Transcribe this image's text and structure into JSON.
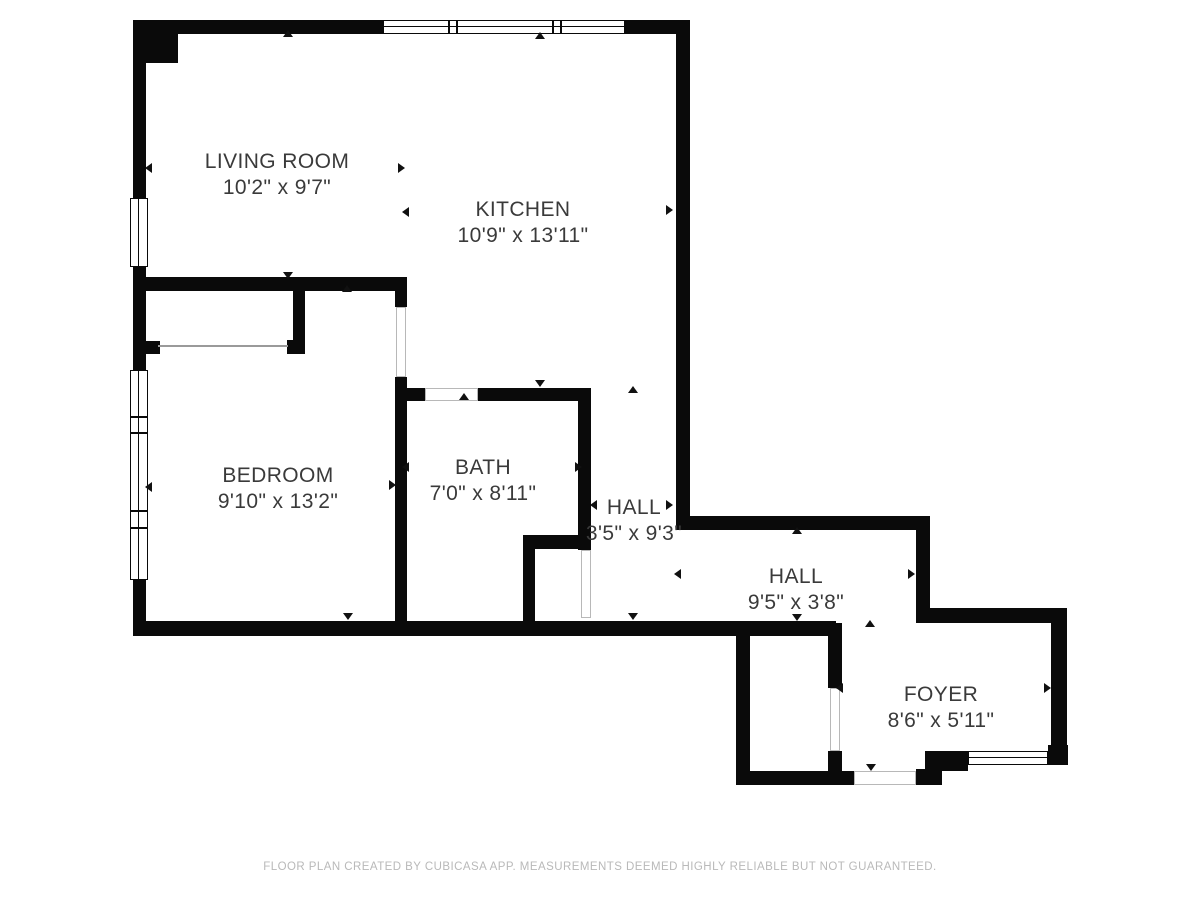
{
  "plan": {
    "rooms": [
      {
        "name": "LIVING ROOM",
        "dims": "10'2\" x 9'7\""
      },
      {
        "name": "KITCHEN",
        "dims": "10'9\" x 13'11\""
      },
      {
        "name": "BEDROOM",
        "dims": "9'10\" x 13'2\""
      },
      {
        "name": "BATH",
        "dims": "7'0\" x 8'11\""
      },
      {
        "name": "HALL",
        "dims": "3'5\" x 9'3\""
      },
      {
        "name": "HALL",
        "dims": "9'5\" x 3'8\""
      },
      {
        "name": "FOYER",
        "dims": "8'6\" x 5'11\""
      }
    ],
    "footer_text": "FLOOR PLAN CREATED BY CUBICASA APP. MEASUREMENTS DEEMED HIGHLY RELIABLE BUT NOT GUARANTEED.",
    "colors": {
      "wall": "#0a0a0a",
      "label": "#3a3a3a",
      "footer": "#b9b9b9"
    }
  }
}
